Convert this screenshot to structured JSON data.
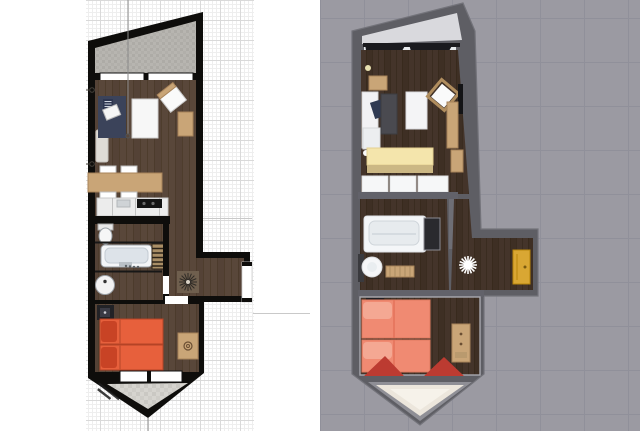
{
  "app": {
    "type": "floor-plan-viewer",
    "description": "Side-by-side top-down views of the same narrow apartment: a 2D architectural plan (left) and a 3D rendered plan (right)"
  },
  "panels": {
    "plan2d": {
      "name": "2D floor plan",
      "bg": "#ffffff"
    },
    "plan3d": {
      "name": "3D floor plan render",
      "bg": "#9b9aa2"
    }
  },
  "rooms": {
    "top_balcony": "balcony",
    "living": "living room with desk, rug, table, chair, dining table",
    "kitchen": "kitchen counter with cooktop",
    "bathroom": "bathroom with toilet, bathtub, towel ladder, sink",
    "hallway": "entrance hall with sunburst floor medallion and front door",
    "bedroom": "bedroom with two single beds, nightstand, dresser",
    "bottom_terrace": "pointed terrace"
  },
  "colors": {
    "wall2d": "#0e0d0b",
    "grid_minor": "#eeeeee",
    "grid_major": "#d9d9d9",
    "wood2d": "#59473a",
    "wood2d_dark": "#483726",
    "balcony2d": "#b6b4af",
    "rug_navy": "#3b435a",
    "furn_tan": "#c9a577",
    "furn_tan_dark": "#a8835a",
    "counter_white": "#ececec",
    "fixture_white": "#f4f6f8",
    "bed_orange": "#e7603c",
    "bed_pillow_red": "#c84325",
    "nightstand_dark": "#222226",
    "terrace2d": "#d4d2cd",
    "bg3d": "#9b9aa2",
    "tile3d": "#90909a",
    "wall3d": "#5e5e64",
    "wall3d_light": "#73737a",
    "wood3d": "#44342a",
    "curtain_black": "#1a1a1e",
    "window_white": "#e6e9ec",
    "bed_salmon": "#f08a72",
    "pillow_salmon": "#f4a893",
    "curtain_red": "#bc3b31",
    "table_yellow": "#f4e5ac",
    "door_yellow": "#d9a733",
    "star_white": "#ffffff",
    "terrace3d": "#ece6dc"
  }
}
